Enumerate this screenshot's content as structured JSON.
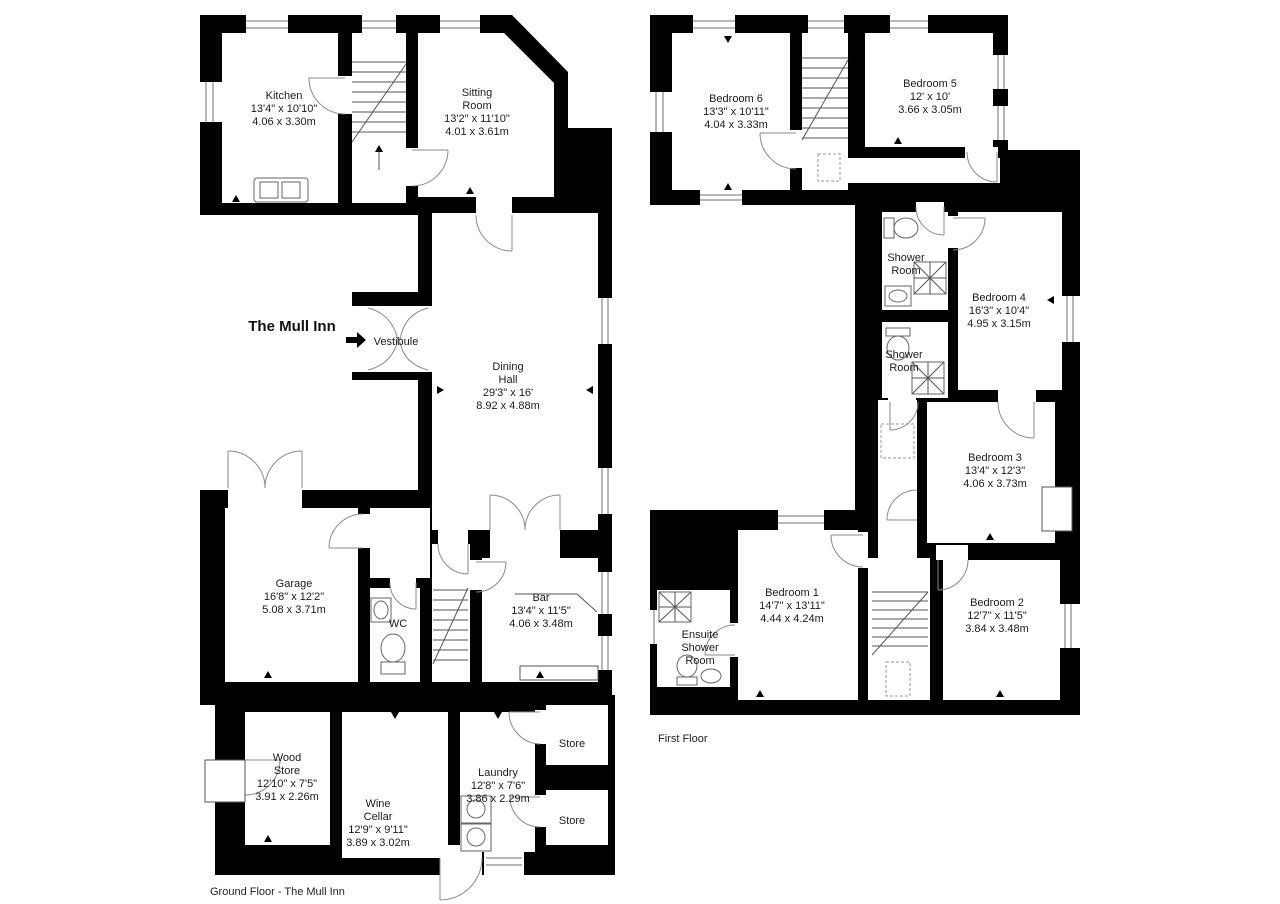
{
  "title": "The Mull Inn",
  "ground_floor": {
    "caption": "Ground Floor - The Mull Inn",
    "rooms": [
      {
        "id": "kitchen",
        "name": "Kitchen",
        "imperial": "13'4\" x 10'10\"",
        "metric": "4.06 x 3.30m"
      },
      {
        "id": "sitting-room",
        "name": "Sitting Room",
        "imperial": "13'2\" x 11'10\"",
        "metric": "4.01 x 3.61m"
      },
      {
        "id": "dining-hall",
        "name": "Dining Hall",
        "imperial": "29'3\" x 16'",
        "metric": "8.92 x 4.88m"
      },
      {
        "id": "vestibule",
        "name": "Vestibule"
      },
      {
        "id": "garage",
        "name": "Garage",
        "imperial": "16'8\" x 12'2\"",
        "metric": "5.08 x 3.71m"
      },
      {
        "id": "wc",
        "name": "WC"
      },
      {
        "id": "bar",
        "name": "Bar",
        "imperial": "13'4\" x 11'5\"",
        "metric": "4.06 x 3.48m"
      },
      {
        "id": "wood-store",
        "name": "Wood Store",
        "imperial": "12'10\" x 7'5\"",
        "metric": "3.91 x 2.26m"
      },
      {
        "id": "wine-cellar",
        "name": "Wine Cellar",
        "imperial": "12'9\" x 9'11\"",
        "metric": "3.89 x 3.02m"
      },
      {
        "id": "laundry",
        "name": "Laundry",
        "imperial": "12'8\" x 7'6\"",
        "metric": "3.86 x 2.29m"
      },
      {
        "id": "store-1",
        "name": "Store"
      },
      {
        "id": "store-2",
        "name": "Store"
      }
    ]
  },
  "first_floor": {
    "caption": "First Floor",
    "rooms": [
      {
        "id": "bedroom-6",
        "name": "Bedroom 6",
        "imperial": "13'3\" x 10'11\"",
        "metric": "4.04 x 3.33m"
      },
      {
        "id": "bedroom-5",
        "name": "Bedroom 5",
        "imperial": "12' x 10'",
        "metric": "3.66 x 3.05m"
      },
      {
        "id": "shower-room-1",
        "name": "Shower Room"
      },
      {
        "id": "bedroom-4",
        "name": "Bedroom 4",
        "imperial": "16'3\" x 10'4\"",
        "metric": "4.95 x 3.15m"
      },
      {
        "id": "shower-room-2",
        "name": "Shower Room"
      },
      {
        "id": "bedroom-3",
        "name": "Bedroom 3",
        "imperial": "13'4\" x 12'3\"",
        "metric": "4.06 x 3.73m"
      },
      {
        "id": "bedroom-1",
        "name": "Bedroom 1",
        "imperial": "14'7\" x 13'11\"",
        "metric": "4.44 x 4.24m"
      },
      {
        "id": "bedroom-2",
        "name": "Bedroom 2",
        "imperial": "12'7\" x 11'5\"",
        "metric": "3.84 x 3.48m"
      },
      {
        "id": "ensuite",
        "name": "Ensuite Shower Room"
      }
    ]
  }
}
